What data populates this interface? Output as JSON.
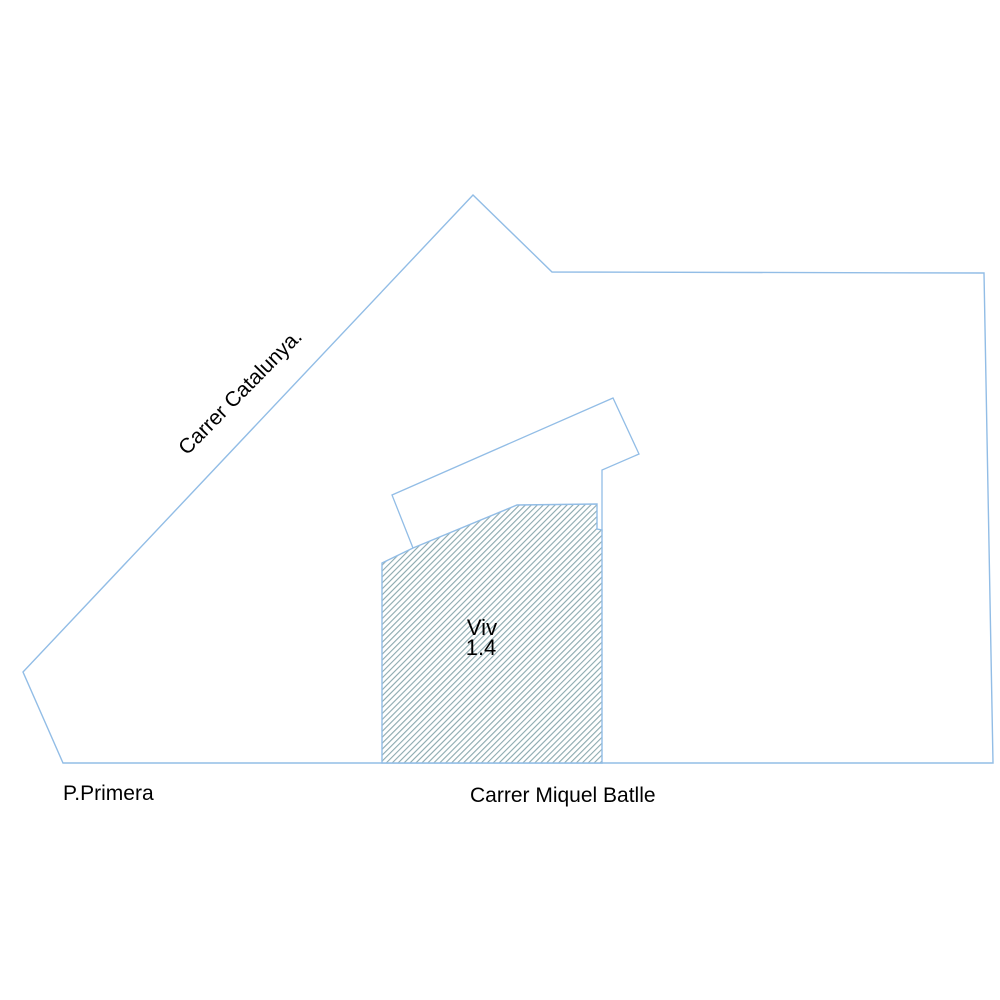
{
  "plan": {
    "streets": {
      "left_diagonal": "Carrer Catalunya.",
      "bottom_left": "P.Primera",
      "bottom_center": "Carrer Miquel Batlle"
    },
    "dwelling": {
      "name": "Viv",
      "number": "1.4"
    },
    "colors": {
      "background": "#ffffff",
      "outline": "#92bde6",
      "outline_soft": "#aecde5",
      "hatch_line": "#7fa0a6",
      "text": "#000000"
    }
  }
}
